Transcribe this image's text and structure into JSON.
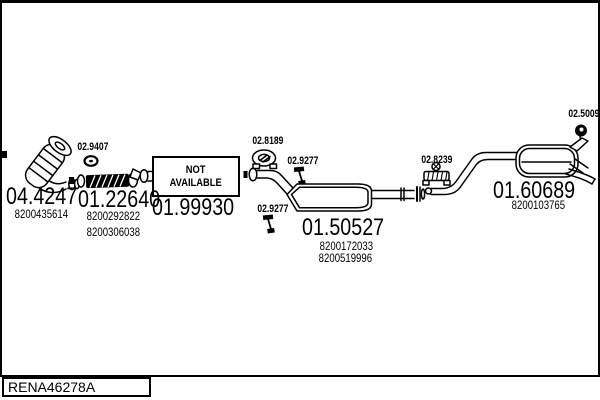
{
  "page": {
    "colors": {
      "ink": "#000000",
      "paper": "#ffffff"
    }
  },
  "footer": {
    "code": "RENA46278A"
  },
  "not_available_box": {
    "line1": "NOT",
    "line2": "AVAILABLE"
  },
  "parts": {
    "front_pipe": {
      "number": "04.4247",
      "refs": [
        "8200435614"
      ]
    },
    "flex_section": {
      "number": "01.22640",
      "refs": [
        "8200292822",
        "8200306038"
      ]
    },
    "unavailable_section": {
      "number": "01.99930",
      "refs": []
    },
    "centre_muffler": {
      "number": "01.50527",
      "refs": [
        "8200172033",
        "8200519996"
      ]
    },
    "rear_muffler": {
      "number": "01.60689",
      "refs": [
        "8200103765"
      ]
    }
  },
  "fittings": [
    {
      "name": "gasket-ring",
      "number": "02.9407"
    },
    {
      "name": "flange-gasket",
      "number": "02.8189"
    },
    {
      "name": "rubber-hanger-upper",
      "number": "02.9277"
    },
    {
      "name": "rubber-hanger-lower",
      "number": "02.9277"
    },
    {
      "name": "pipe-clamp",
      "number": "02.8239"
    },
    {
      "name": "rubber-mount",
      "number": "02.5009"
    }
  ]
}
